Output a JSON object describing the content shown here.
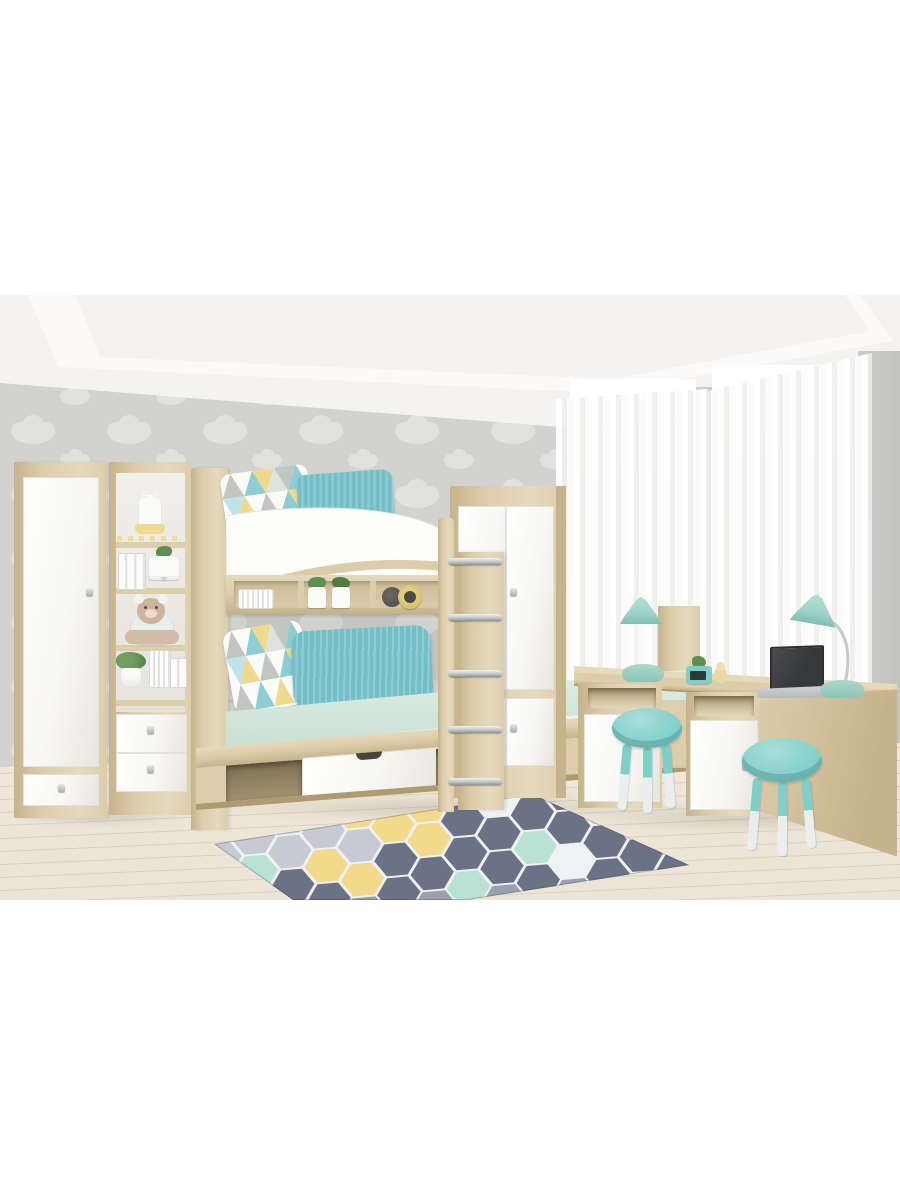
{
  "meta": {
    "domain": "Natural-Image",
    "description": "Product photo of a children's bedroom furniture set in light sonoma oak and glossy white with teal accents: a bunk bed with under-bed drawer and ladder, two wardrobes, an open bookshelf with toys, a wall shelf, and a double desk with two stools by tall curtained windows. No text appears in the image."
  },
  "scene": {
    "room": {
      "wallpaper": "Grey wall with white cloud-pattern wallpaper",
      "ceiling": "White tray ceiling",
      "wall_right": "Plain grey wall piers beside the windows",
      "window_left": "Tall bright window",
      "window_right": "Tall bright window",
      "curtains": "Sheer white floor-length curtains",
      "floor": "Pale wooden plank floor",
      "rug": "Grey hexagon rug with mint, yellow and white honeycomb tiles"
    },
    "furniture": {
      "left_wardrobe": "Tall oak wardrobe with white door and bottom drawer",
      "bookshelf": "Open oak shelving unit with four shelves and two white drawers",
      "bunk_bed": "Oak bunk bed with white curved upper guard rail and arch",
      "upper_rail": "Curved white safety rail of the upper bunk",
      "wall_shelf": "Oak shelf between the bunks with compartments",
      "mattress": "Mint-green lower bunk mattress",
      "bed_drawer": "White pull-out storage drawer under the bed",
      "bed_cubby": "Open storage cubby under the bed",
      "ladder": "Oak ladder with chrome rungs",
      "right_wardrobe": "Two-door oak wardrobe with white glossy fronts",
      "desk": "Double oak desk with open niches and white cabinet doors",
      "stool_left": "Round teal stool with white-tipped legs",
      "stool_right": "Round teal stool with white-tipped legs"
    },
    "decor": {
      "cat_figurine": "White cat figurine with yellow skirt on top shelf",
      "garland": "Tiny yellow pennant garland",
      "books": "White picture books",
      "dog_planter": "White dog-shaped planter with green plant",
      "teddy_bear": "Plush teddy bear in a mint hoodie",
      "potted_plant": "Green plant in white pot",
      "canisters": "White storage canisters",
      "storage_boxes": "Small white storage boxes",
      "pillows_upper": "Triangle-print and teal pillows on the upper bunk",
      "pillows_lower": "Triangle-print and teal pillows on the lower bunk",
      "planters": "Two white cat-face planters with greenery",
      "alarm_clock": "Round yellow alarm clock and dark disc",
      "lamp_left": "Teal dome desk lamp",
      "lamp_right": "Teal dome desk lamp on curved arm",
      "laptop": "Open laptop with dark screen",
      "pencil_cup": "Teal pencil box with digital clock",
      "duck_figurine": "Small yellow duck figurine"
    }
  },
  "colors": {
    "wall": "#d2d3d1",
    "cloud": "#e1e2e0",
    "ceiling": "#f4f3f1",
    "ceilingBright": "#fbfaf8",
    "trayBand": "#eceue9",
    "oak": "#dccdab",
    "oakLight": "#e6d9bc",
    "oakDark": "#c6b28b",
    "oakDeep": "#b09a72",
    "interiorDark": "#a8986f",
    "furnWhite": "#f8f7f3",
    "furnWhiteShade": "#e8e6e0",
    "chrome": "#c2c7c9",
    "mattressMint": "#dfeee6",
    "mattressMintDark": "#c9e0d4",
    "bedRimWhite": "#f3f4f0",
    "pillowTeal": "#74bfc7",
    "lampTeal": "#9ed3c8",
    "stoolTeal": "#7fceca",
    "stoolLeg": "#ebeeee",
    "accentYellow": "#eeda8f",
    "plantGreen": "#5e8f52",
    "plushBeige": "#cdb49b",
    "plushMint": "#e6f0ea",
    "laptopDark": "#36383b",
    "laptopBase": "#b6b9ba",
    "floor": "#ece4d6",
    "plank": "#ded3c1",
    "curtain": "#f5f4f1",
    "windowGlow": "#ffffff",
    "wallRight": "#cccccb",
    "rugBase": "#99a0b0",
    "rugDark": "#6b7286",
    "rugLight": "#c7cad2",
    "rugMint": "#b9e2d4",
    "rugYellow": "#f2d98b",
    "rugWhite": "#eff1f2",
    "shadow": "rgba(115,105,90,0.22)"
  }
}
